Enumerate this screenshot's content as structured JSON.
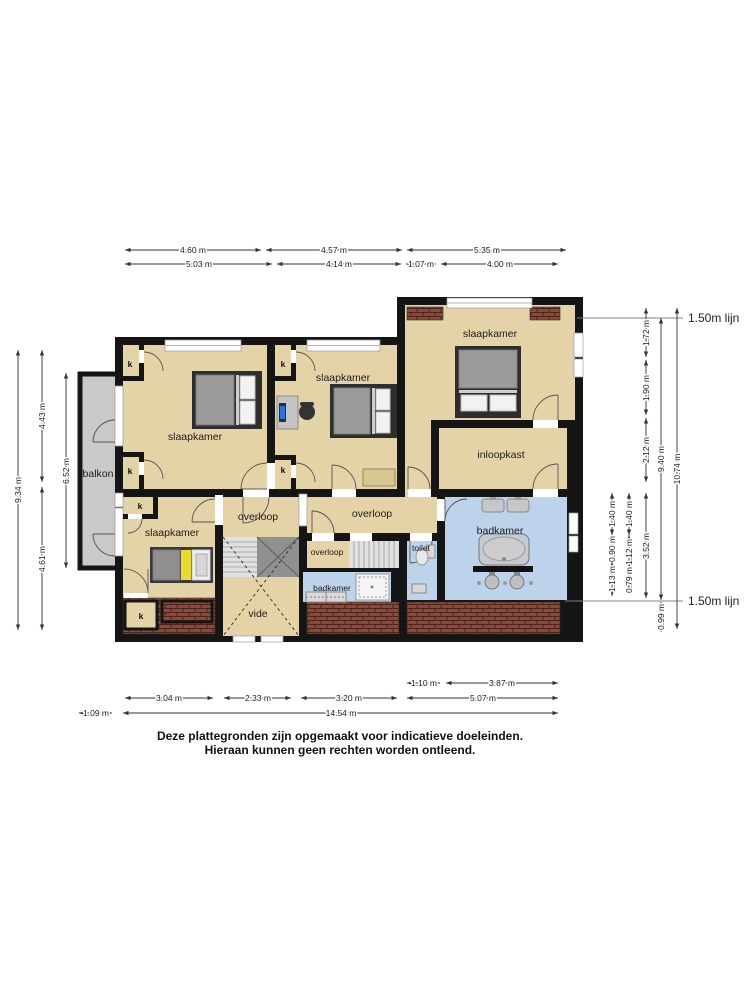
{
  "floorplan": {
    "rooms": {
      "slaapkamer": "slaapkamer",
      "badkamer": "badkamer",
      "overloop": "overloop",
      "inloopkast": "inloopkast",
      "toilet": "toilet",
      "vide": "vide",
      "balkon": "balkon",
      "closet": "k"
    },
    "reference_lines": {
      "line_150": "1.50m lijn"
    },
    "dimensions": {
      "top_row1": [
        "4.60 m",
        "4.57 m",
        "5.35 m"
      ],
      "top_row2": [
        "5.03 m",
        "4.14 m",
        "1.07 m",
        "4.00 m"
      ],
      "left_outer": "9.34 m",
      "left_mid": [
        "4.43 m",
        "4.61 m"
      ],
      "left_inner": "6.52 m",
      "right_col1": [
        "1.40 m",
        "0.90 m",
        "1.13 m"
      ],
      "right_col2": [
        "1.40 m",
        "1.12 m",
        "0.79 m"
      ],
      "right_col3": [
        "1.72 m",
        "1.90 m",
        "2.12 m",
        "3.52 m"
      ],
      "right_col4": [
        "9.40 m",
        "0.99 m"
      ],
      "right_outer": "10.74 m",
      "bottom_row1": [
        "1.10 m",
        "3.87 m"
      ],
      "bottom_row2": [
        "3.04 m",
        "2.33 m",
        "3.20 m",
        "5.07 m"
      ],
      "bottom_row3": [
        "1.09 m",
        "14.54 m"
      ]
    },
    "colors": {
      "wall": "#151515",
      "floor_tan": "#E3D3A6",
      "bathroom_blue": "#BDD3EB",
      "balcony_grey": "#C9C9C9",
      "roof_brick": "#8A4A3B",
      "bed_accent_yellow": "#E9DA2D"
    },
    "footer": {
      "line1": "Deze plattegronden zijn opgemaakt voor indicatieve doeleinden.",
      "line2": "Hieraan kunnen geen rechten worden ontleend."
    }
  }
}
